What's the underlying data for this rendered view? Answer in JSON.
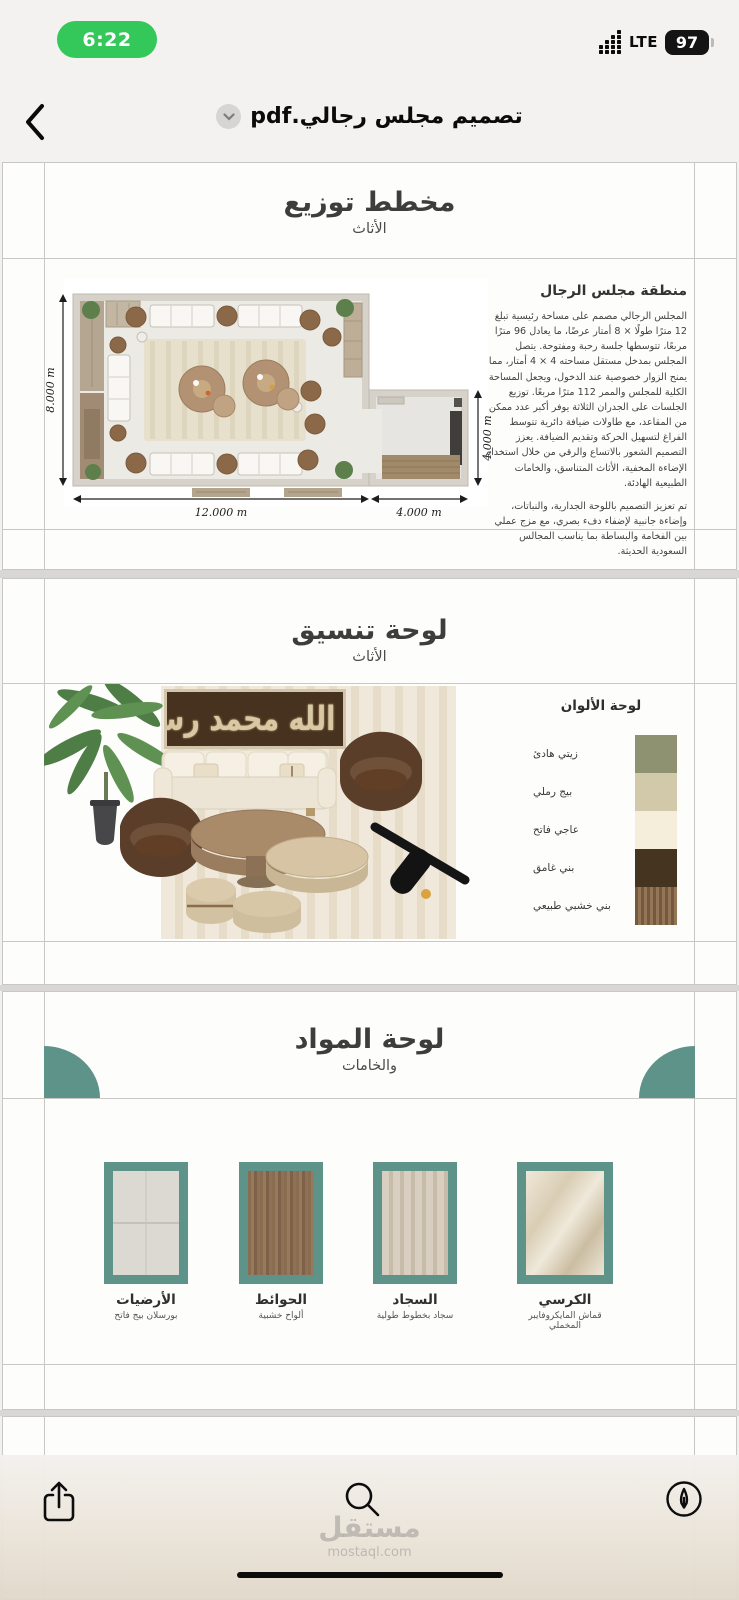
{
  "status": {
    "time": "6:22",
    "network": "LTE",
    "battery": "97"
  },
  "nav": {
    "filename": "تصميم مجلس رجالي.pdf"
  },
  "icons": {
    "back": "chevron-left",
    "dropdown": "chevron-down",
    "signal": "cellular-bars",
    "share": "share-up-arrow",
    "search": "magnifier",
    "markup": "pencil-circle"
  },
  "page_plan": {
    "title": "مخطط توزيع",
    "subtitle": "الأثاث",
    "section_title": "منطقة مجلس الرجال",
    "paragraph1": "المجلس الرجالي مصمم على مساحة رئيسية تبلغ 12 مترًا طولًا × 8 أمتار عرضًا، ما يعادل 96 مترًا مربعًا، تتوسطها جلسة رحبة ومفتوحة. يتصل المجلس بمدخل مستقل مساحته 4 × 4 أمتار، مما يمنح الزوار خصوصية عند الدخول، ويجعل المساحة الكلية للمجلس والممر 112 مترًا مربعًا. توزيع الجلسات على الجدران الثلاثة يوفر أكبر عدد ممكن من المقاعد، مع طاولات ضيافة دائرية تتوسط الفراغ لتسهيل الحركة وتقديم الضيافة. يعزز التصميم الشعور بالاتساع والرقي من خلال استخدام الإضاءة المخفية، الأثاث المتناسق، والخامات الطبيعية الهادئة.",
    "paragraph2": "تم تعزيز التصميم باللوحة الجدارية، والنباتات، وإضاءة جانبية لإضفاء دفء بصري، مع مزج عملي بين الفخامة والبساطة بما يناسب المجالس السعودية الحديثة.",
    "dim_width": "12.000 m",
    "dim_entry_width": "4.000 m",
    "dim_height": "8.000 m",
    "dim_entry_height": "4.000 m"
  },
  "page_mood": {
    "title": "لوحة تنسيق",
    "subtitle": "الأثاث",
    "calligraphy": "لا إله إلا الله محمد رسول الله",
    "palette_title": "لوحة الألوان",
    "palette": [
      {
        "label": "زيتي هادئ",
        "color": "#8e9270"
      },
      {
        "label": "بيج رملي",
        "color": "#d2c9ab"
      },
      {
        "label": "عاجي فاتح",
        "color": "#f4eeda"
      },
      {
        "label": "بني غامق",
        "color": "#443420"
      },
      {
        "label": "بني خشبي طبيعي",
        "color": "#8a6a4a"
      }
    ]
  },
  "page_materials": {
    "title": "لوحة المواد",
    "subtitle": "والخامات",
    "items": [
      {
        "name": "الأرضيات",
        "desc": "بورسلان بيج فاتح"
      },
      {
        "name": "الحوائط",
        "desc": "ألواح خشبية"
      },
      {
        "name": "السجاد",
        "desc": "سجاد بخطوط طولية"
      },
      {
        "name": "الكرسي",
        "desc": "قماش المايكروفايبر المخملي"
      }
    ]
  },
  "watermark": {
    "brand": "مستقل",
    "domain": "mostaql.com"
  },
  "colors": {
    "accent_teal": "#5d9388",
    "time_pill_green": "#34c759"
  }
}
